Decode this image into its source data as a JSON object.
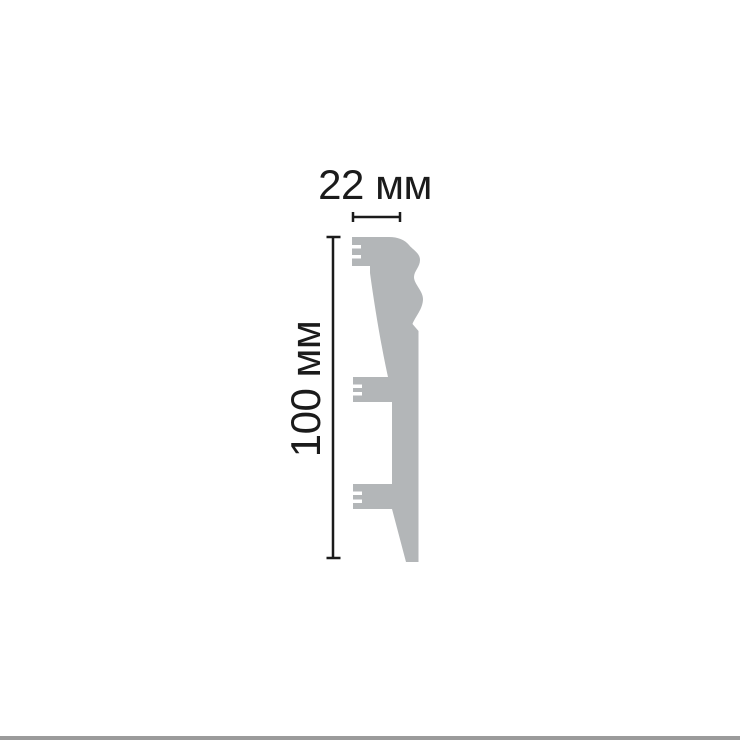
{
  "page": {
    "background": "#ffffff",
    "bottom_bar_color": "#9b9b9b"
  },
  "diagram": {
    "width_dimension": {
      "label": "22 мм"
    },
    "height_dimension": {
      "label": "100 мм"
    },
    "profile_fill": "#b3b6b8",
    "dimension_line_color": "#1b1b1b",
    "label_color": "#1b1b1b"
  }
}
